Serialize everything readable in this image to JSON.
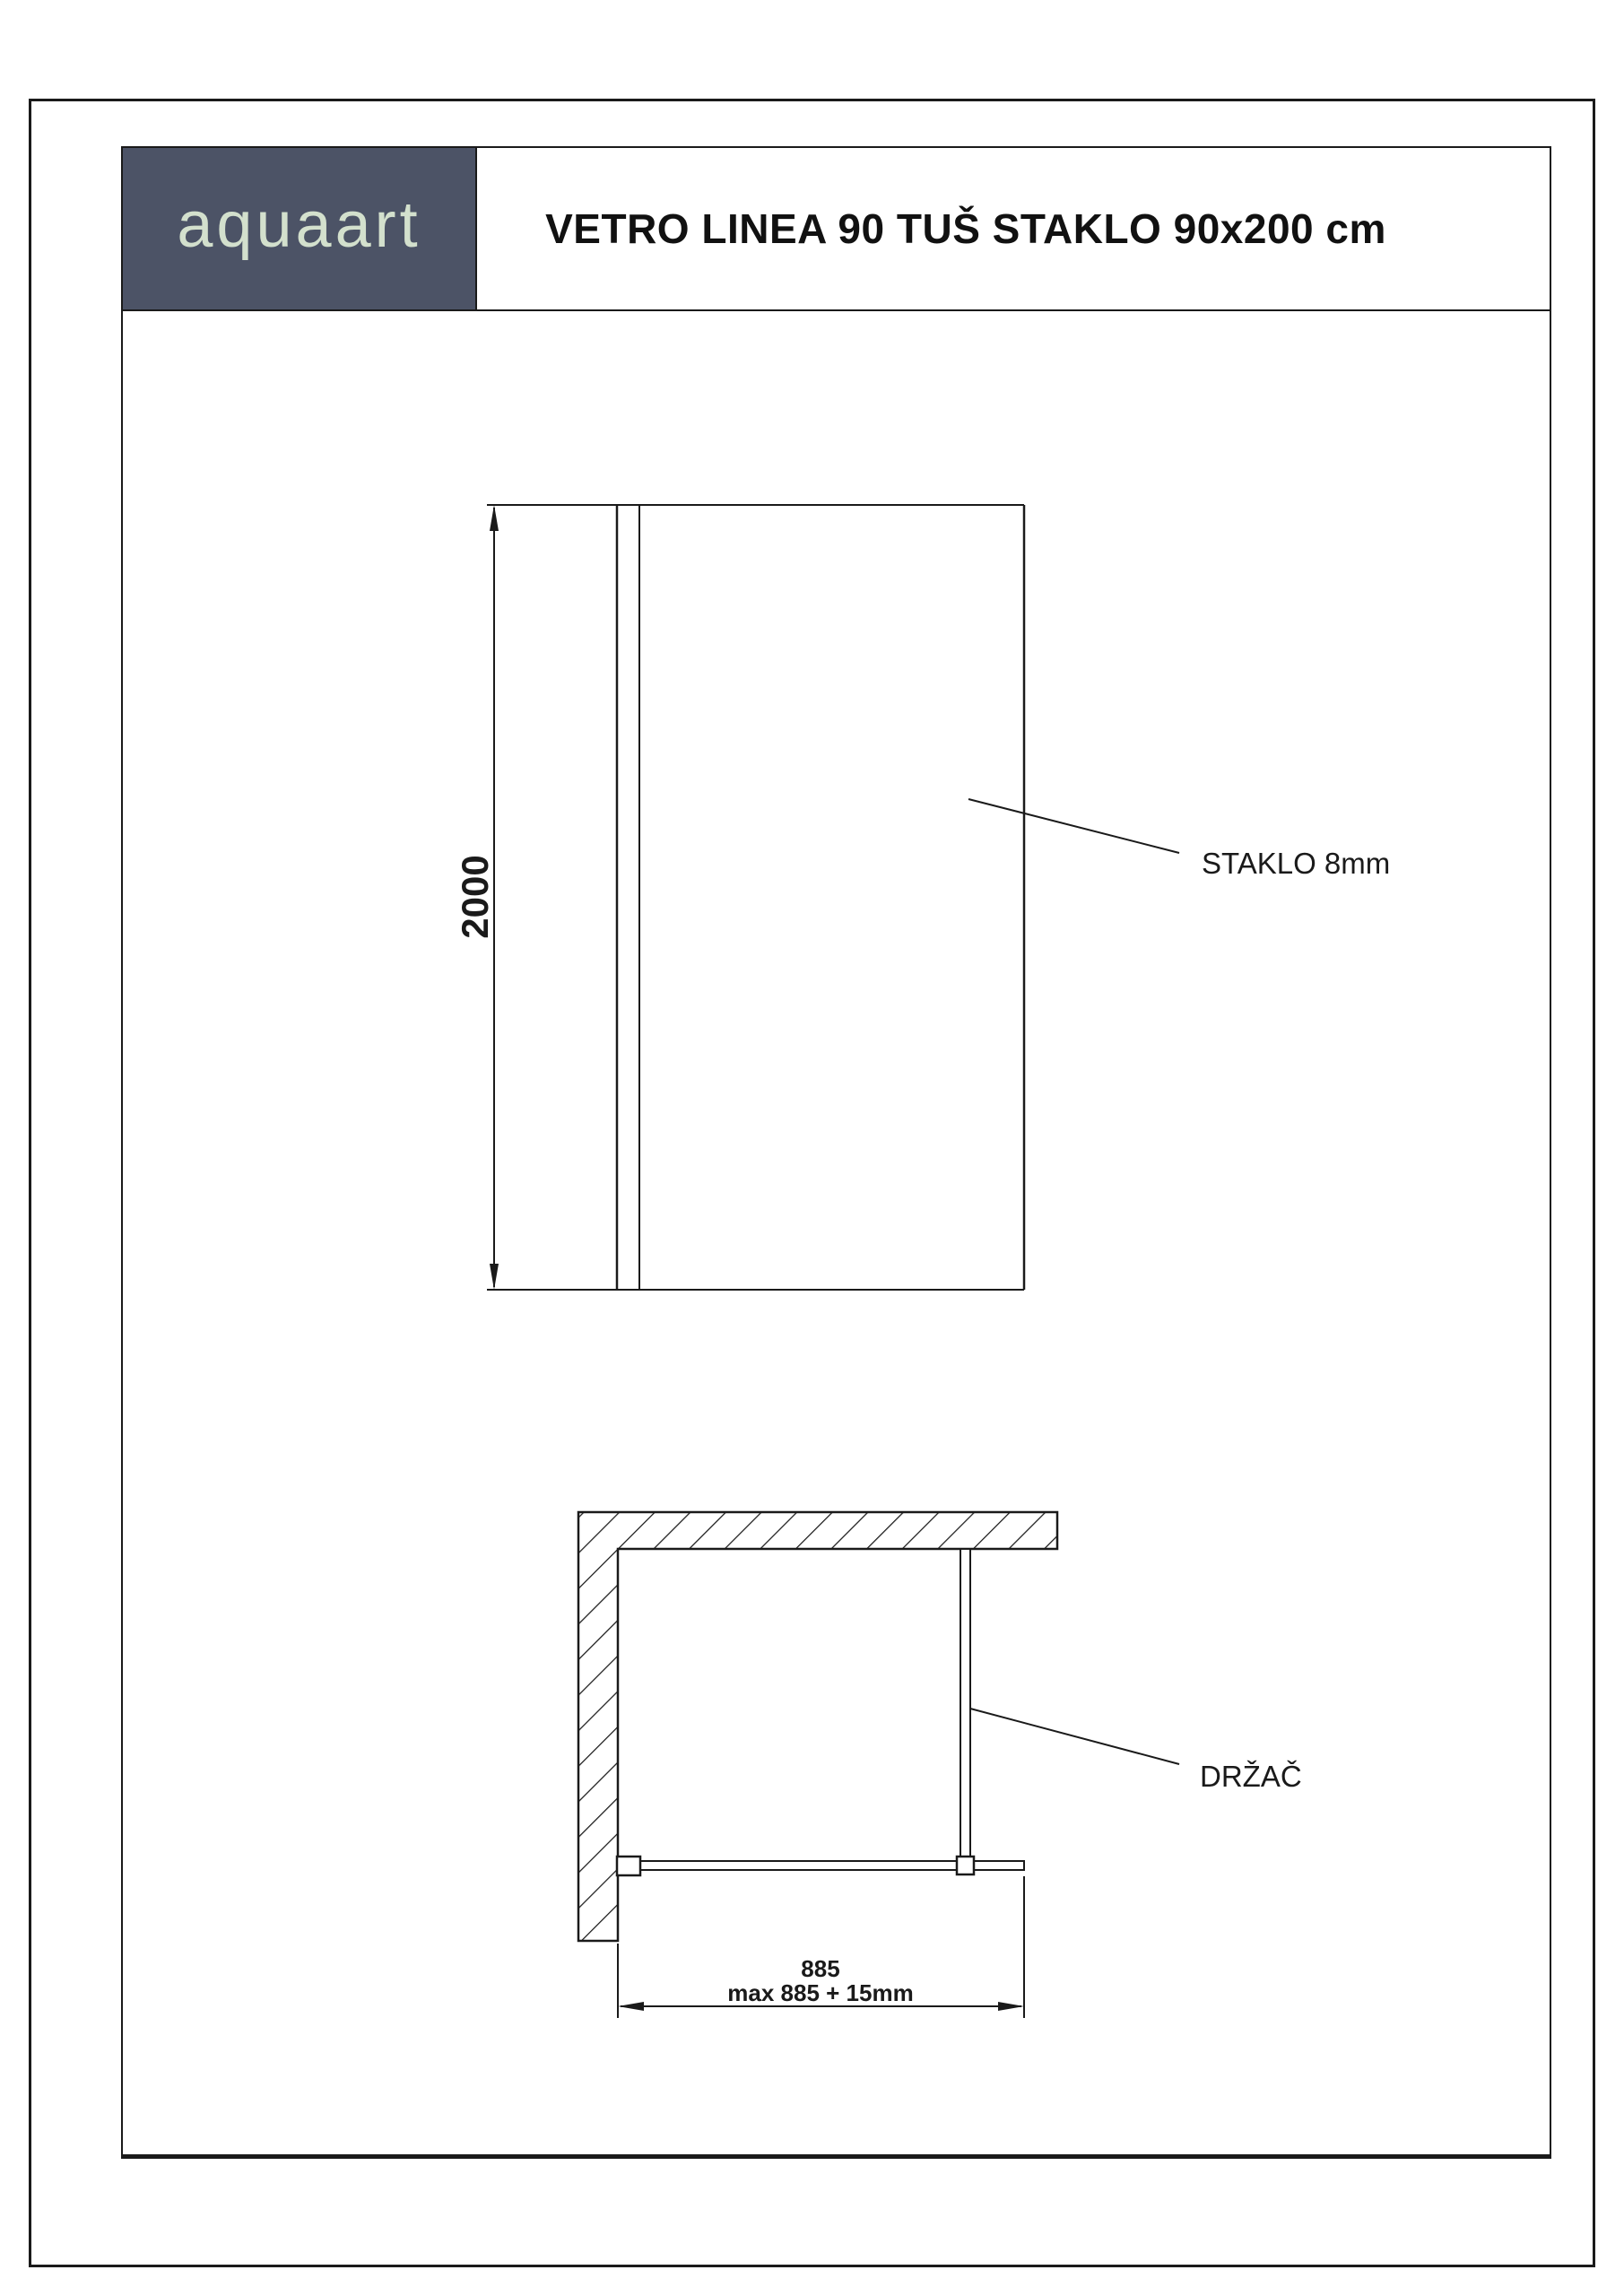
{
  "header": {
    "logo_text": "aquaart",
    "title": "VETRO LINEA 90 TUŠ STAKLO 90x200 cm"
  },
  "front_view": {
    "height_dim": "2000",
    "glass_label": "STAKLO 8mm"
  },
  "plan_view": {
    "width_dim": "885",
    "width_dim_max": "max 885 + 15mm",
    "holder_label": "DRŽAČ"
  },
  "colors": {
    "logo_bg": "#4c5366",
    "logo_text": "#d3e0cd",
    "line": "#1a1a1a"
  }
}
